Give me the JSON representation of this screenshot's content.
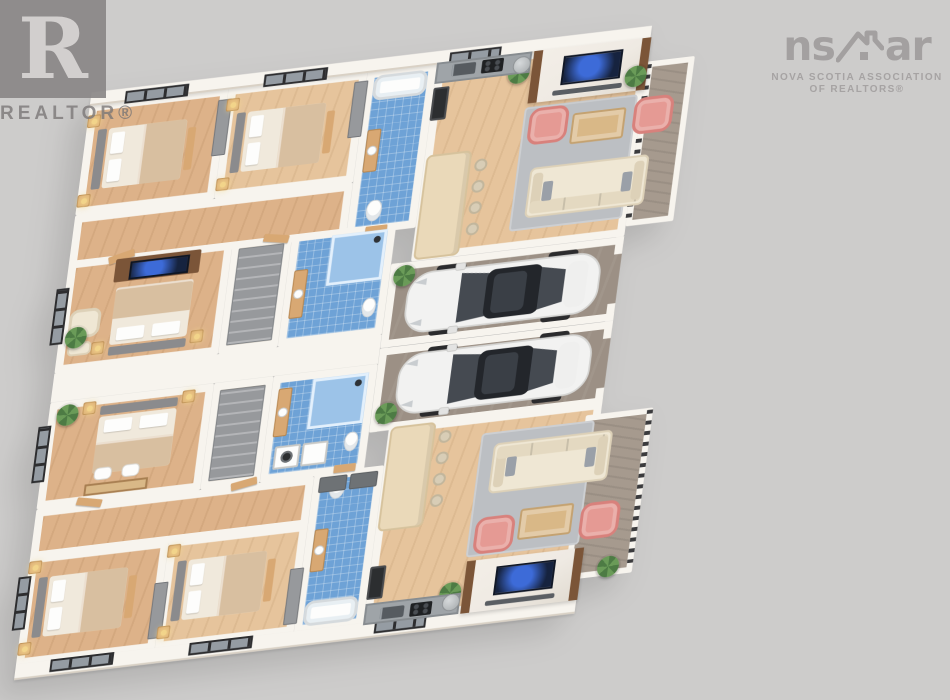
{
  "watermarks": {
    "realtor_glyph": "R",
    "realtor_label": "REALTOR®",
    "nsar_left": "ns",
    "nsar_right": "ar",
    "nsar_sub1": "NOVA SCOTIA ASSOCIATION",
    "nsar_sub2": "OF REALTORS®"
  },
  "palette": {
    "bg": "#cdcccb",
    "wall": "#f7f4ee",
    "wallEdge": "#d9d1c5",
    "wood": "#ddb289",
    "wood2": "#e6c49c",
    "trim": "#d8a873",
    "tile": "#6ea2d6",
    "tileLine": "rgba(255,255,255,0.28)",
    "garage": "#9c9085",
    "deck": "#a69a8e",
    "rug": "#bcbfc3",
    "sofa": "#efe7d4",
    "sofaEdge": "#ddd1b8",
    "pink": "#e59a94",
    "pinkEdge": "#d8817c",
    "linen": "#f0e9dc",
    "blanket": "#d8bfa0",
    "head": "#8b8b8d",
    "cab": "#97999c",
    "counter": "#9fa4a8",
    "counterEdge": "#878c90",
    "island": "#ead9b9",
    "islandEdge": "#d6c29c",
    "steel": "#b4b8ba",
    "car": "#f3f3f2",
    "glass": "#33373d",
    "plant": "#4d7b44",
    "plant2": "#6a9b58",
    "marble": "#efeae3",
    "tvf": "#7b5538",
    "screenc": "#16233f",
    "lamp": "#f2d48a",
    "white": "#fdfdfc",
    "appl": "#2c2e30",
    "rail": "#3b3b3d",
    "winGlass": "#959ca3",
    "winFrame": "#2d2d2f",
    "stoolc": "#d8cdb6",
    "stoolEdge": "#c2b69c",
    "benchg": "#6e7275",
    "deskc": "#d9b887"
  },
  "scene": {
    "units": 2,
    "cars": 2,
    "bedrooms_per_unit": 3,
    "bathrooms_per_unit": 2,
    "items": [
      {
        "t": "room wood",
        "n": "bedroom-1",
        "x": 0,
        "y": 0,
        "w": 140,
        "h": 115
      },
      {
        "t": "room wood2",
        "n": "bedroom-2",
        "x": 140,
        "y": 0,
        "w": 140,
        "h": 115
      },
      {
        "t": "room wood",
        "n": "hallway-top",
        "x": 0,
        "y": 115,
        "w": 280,
        "h": 55
      },
      {
        "t": "room tile",
        "n": "bathroom-1",
        "x": 280,
        "y": 0,
        "w": 70,
        "h": 170
      },
      {
        "t": "room wood2",
        "n": "living-kitchen-1",
        "x": 350,
        "y": 0,
        "w": 215,
        "h": 205
      },
      {
        "t": "room wood",
        "n": "master-bedroom-1",
        "x": 0,
        "y": 162,
        "w": 165,
        "h": 116
      },
      {
        "t": "room wood2",
        "n": "closet-1",
        "x": 165,
        "y": 162,
        "w": 60,
        "h": 116
      },
      {
        "t": "room tile",
        "n": "bathroom-2",
        "x": 225,
        "y": 162,
        "w": 105,
        "h": 116
      },
      {
        "t": "room garage",
        "n": "garage-bay-1",
        "x": 330,
        "y": 205,
        "w": 235,
        "h": 87
      },
      {
        "t": "room garage",
        "n": "garage-bay-2",
        "x": 330,
        "y": 292,
        "w": 235,
        "h": 87
      },
      {
        "t": "room wood",
        "n": "master-bedroom-2",
        "x": 0,
        "y": 308,
        "w": 165,
        "h": 110
      },
      {
        "t": "room wood2",
        "n": "closet-2",
        "x": 165,
        "y": 308,
        "w": 60,
        "h": 110
      },
      {
        "t": "room tile",
        "n": "bathroom-3",
        "x": 225,
        "y": 308,
        "w": 105,
        "h": 110
      },
      {
        "t": "room wood",
        "n": "hallway-bottom",
        "x": 0,
        "y": 418,
        "w": 280,
        "h": 52
      },
      {
        "t": "room tile",
        "n": "bathroom-4",
        "x": 280,
        "y": 415,
        "w": 70,
        "h": 165
      },
      {
        "t": "room wood",
        "n": "bedroom-3",
        "x": 0,
        "y": 466,
        "w": 140,
        "h": 114
      },
      {
        "t": "room wood2",
        "n": "bedroom-4",
        "x": 140,
        "y": 466,
        "w": 140,
        "h": 114
      },
      {
        "t": "room wood2",
        "n": "living-kitchen-2",
        "x": 350,
        "y": 375,
        "w": 215,
        "h": 205
      },
      {
        "t": "room deck",
        "n": "deck-1",
        "x": 565,
        "y": 25,
        "w": 48,
        "h": 170
      },
      {
        "t": "room deck",
        "n": "deck-2",
        "x": 550,
        "y": 388,
        "w": 68,
        "h": 170
      },
      {
        "t": "wallband",
        "n": "party-wall",
        "x": 0,
        "y": 278,
        "w": 330,
        "h": 30
      },
      {
        "t": "facade",
        "n": "north-facade",
        "x": 0,
        "y": -12,
        "w": 565,
        "h": 14
      },
      {
        "t": "facade",
        "n": "south-facade",
        "x": 0,
        "y": 578,
        "w": 565,
        "h": 16
      },
      {
        "t": "stub",
        "n": "garage-door-jamb",
        "x": 557,
        "y": 205,
        "w": 8,
        "h": 18
      },
      {
        "t": "stub",
        "n": "garage-door-jamb",
        "x": 557,
        "y": 274,
        "w": 8,
        "h": 18
      },
      {
        "t": "stub",
        "n": "garage-door-jamb",
        "x": 557,
        "y": 292,
        "w": 8,
        "h": 18
      },
      {
        "t": "stub",
        "n": "garage-door-jamb",
        "x": 557,
        "y": 361,
        "w": 8,
        "h": 18
      },
      {
        "t": "winh",
        "n": "window",
        "x": 35,
        "y": -9,
        "w": 64,
        "h": 13
      },
      {
        "t": "winh",
        "n": "window",
        "x": 175,
        "y": -9,
        "w": 64,
        "h": 13
      },
      {
        "t": "winh",
        "n": "window",
        "x": 362,
        "y": -9,
        "w": 52,
        "h": 13
      },
      {
        "t": "winh",
        "n": "window",
        "x": 35,
        "y": 577,
        "w": 64,
        "h": 13
      },
      {
        "t": "winh",
        "n": "window",
        "x": 175,
        "y": 577,
        "w": 64,
        "h": 13
      },
      {
        "t": "winh",
        "n": "window",
        "x": 362,
        "y": 577,
        "w": 52,
        "h": 13
      },
      {
        "t": "winv",
        "n": "window",
        "x": -9,
        "y": 190,
        "w": 13,
        "h": 58
      },
      {
        "t": "winv",
        "n": "window",
        "x": -9,
        "y": 332,
        "w": 13,
        "h": 58
      },
      {
        "t": "winv",
        "n": "window",
        "x": -9,
        "y": 487,
        "w": 13,
        "h": 55
      },
      {
        "t": "railv",
        "n": "deck-railing",
        "x": 564,
        "y": 28,
        "w": 6,
        "h": 164
      },
      {
        "t": "railv",
        "n": "deck-railing",
        "x": 612,
        "y": 390,
        "w": 6,
        "h": 164
      },
      {
        "t": "door",
        "n": "door",
        "x": 40,
        "y": 160,
        "w": 26,
        "h": 8,
        "r": -14
      },
      {
        "t": "door",
        "n": "door",
        "x": 196,
        "y": 160,
        "w": 26,
        "h": 8,
        "r": 10
      },
      {
        "t": "door",
        "n": "door",
        "x": 299,
        "y": 163,
        "w": 22,
        "h": 8
      },
      {
        "t": "door",
        "n": "door",
        "x": 40,
        "y": 413,
        "w": 26,
        "h": 8,
        "r": 12
      },
      {
        "t": "door",
        "n": "door",
        "x": 196,
        "y": 413,
        "w": 26,
        "h": 8,
        "r": -10
      },
      {
        "t": "door",
        "n": "door",
        "x": 299,
        "y": 409,
        "w": 22,
        "h": 8
      },
      {
        "t": "dresser",
        "n": "dresser",
        "x": 131,
        "y": 12,
        "w": 14,
        "h": 58
      },
      {
        "t": "dresser",
        "n": "dresser",
        "x": 268,
        "y": 10,
        "w": 14,
        "h": 58
      },
      {
        "t": "dresser",
        "n": "dresser",
        "x": 131,
        "y": 510,
        "w": 14,
        "h": 58
      },
      {
        "t": "dresser",
        "n": "dresser",
        "x": 268,
        "y": 512,
        "w": 14,
        "h": 58
      },
      {
        "t": "bed",
        "n": "bed",
        "x": 12,
        "y": 28,
        "w": 100,
        "h": 62
      },
      {
        "t": "bed",
        "n": "bed",
        "x": 152,
        "y": 28,
        "w": 100,
        "h": 62
      },
      {
        "t": "bed",
        "n": "bed",
        "x": 12,
        "y": 490,
        "w": 100,
        "h": 62
      },
      {
        "t": "bed",
        "n": "bed",
        "x": 152,
        "y": 490,
        "w": 100,
        "h": 62
      },
      {
        "t": "bed",
        "v": "v hb-s",
        "n": "bed",
        "x": 52,
        "y": 196,
        "w": 78,
        "h": 70
      },
      {
        "t": "bed",
        "v": "v hb-n",
        "n": "bed",
        "x": 52,
        "y": 318,
        "w": 78,
        "h": 70
      },
      {
        "t": "ns",
        "n": "nightstand-lamp",
        "x": 0,
        "y": 12,
        "w": 13,
        "h": 13
      },
      {
        "t": "ns",
        "n": "nightstand-lamp",
        "x": 0,
        "y": 94,
        "w": 13,
        "h": 13
      },
      {
        "t": "ns",
        "n": "nightstand-lamp",
        "x": 140,
        "y": 12,
        "w": 13,
        "h": 13
      },
      {
        "t": "ns",
        "n": "nightstand-lamp",
        "x": 140,
        "y": 94,
        "w": 13,
        "h": 13
      },
      {
        "t": "ns",
        "n": "nightstand-lamp",
        "x": 0,
        "y": 472,
        "w": 13,
        "h": 13
      },
      {
        "t": "ns",
        "n": "nightstand-lamp",
        "x": 0,
        "y": 556,
        "w": 13,
        "h": 13
      },
      {
        "t": "ns",
        "n": "nightstand-lamp",
        "x": 140,
        "y": 472,
        "w": 13,
        "h": 13
      },
      {
        "t": "ns",
        "n": "nightstand-lamp",
        "x": 140,
        "y": 556,
        "w": 13,
        "h": 13
      },
      {
        "t": "ns",
        "n": "nightstand-lamp",
        "x": 34,
        "y": 250,
        "w": 13,
        "h": 13
      },
      {
        "t": "ns",
        "n": "nightstand-lamp",
        "x": 134,
        "y": 250,
        "w": 13,
        "h": 13
      },
      {
        "t": "ns",
        "n": "nightstand-lamp",
        "x": 34,
        "y": 312,
        "w": 13,
        "h": 13
      },
      {
        "t": "ns",
        "n": "nightstand-lamp",
        "x": 134,
        "y": 312,
        "w": 13,
        "h": 13
      },
      {
        "t": "tvc",
        "n": "tv-console",
        "x": 48,
        "y": 166,
        "w": 86,
        "h": 24
      },
      {
        "t": "armch",
        "n": "armchair",
        "x": 8,
        "y": 214,
        "w": 32,
        "h": 30
      },
      {
        "t": "otto",
        "n": "ottoman",
        "x": 10,
        "y": 248,
        "w": 24,
        "h": 14
      },
      {
        "t": "desk",
        "n": "desk",
        "x": 46,
        "y": 398,
        "w": 64,
        "h": 12
      },
      {
        "t": "chairw",
        "n": "chair",
        "x": 54,
        "y": 382,
        "w": 18,
        "h": 13
      },
      {
        "t": "chairw",
        "n": "chair",
        "x": 82,
        "y": 382,
        "w": 18,
        "h": 13
      },
      {
        "t": "shelf",
        "n": "closet-shelving",
        "x": 172,
        "y": 170,
        "w": 46,
        "h": 100
      },
      {
        "t": "shelf",
        "n": "closet-shelving",
        "x": 172,
        "y": 316,
        "w": 46,
        "h": 94
      },
      {
        "t": "tub",
        "n": "bathtub",
        "x": 288,
        "y": 6,
        "w": 54,
        "h": 26
      },
      {
        "t": "wc",
        "n": "toilet",
        "x": 297,
        "y": 136,
        "w": 16,
        "h": 22
      },
      {
        "t": "vanity",
        "n": "vanity",
        "x": 288,
        "y": 62,
        "w": 14,
        "h": 44
      },
      {
        "t": "tub",
        "n": "bathtub",
        "x": 288,
        "y": 548,
        "w": 54,
        "h": 26
      },
      {
        "t": "wc",
        "n": "toilet",
        "x": 297,
        "y": 422,
        "w": 16,
        "h": 22
      },
      {
        "t": "vanity",
        "n": "vanity",
        "x": 288,
        "y": 474,
        "w": 14,
        "h": 44
      },
      {
        "t": "shower",
        "n": "shower",
        "x": 266,
        "y": 168,
        "w": 56,
        "h": 52
      },
      {
        "t": "vanity",
        "n": "vanity",
        "x": 232,
        "y": 200,
        "w": 14,
        "h": 50
      },
      {
        "t": "wc",
        "n": "toilet",
        "x": 306,
        "y": 238,
        "w": 14,
        "h": 20
      },
      {
        "t": "shower",
        "n": "shower",
        "x": 266,
        "y": 316,
        "w": 56,
        "h": 52
      },
      {
        "t": "vanity",
        "n": "vanity",
        "x": 232,
        "y": 322,
        "w": 14,
        "h": 50
      },
      {
        "t": "wc",
        "n": "toilet",
        "x": 306,
        "y": 376,
        "w": 14,
        "h": 20
      },
      {
        "t": "washer",
        "n": "washing-machine",
        "x": 236,
        "y": 382,
        "w": 26,
        "h": 24
      },
      {
        "t": "dryer",
        "n": "dryer",
        "x": 264,
        "y": 382,
        "w": 26,
        "h": 24
      },
      {
        "t": "benchg",
        "n": "bench",
        "x": 286,
        "y": 420,
        "w": 28,
        "h": 16
      },
      {
        "t": "benchg",
        "n": "bench",
        "x": 317,
        "y": 420,
        "w": 28,
        "h": 16
      },
      {
        "t": "rug",
        "n": "area-rug",
        "x": 446,
        "y": 58,
        "w": 114,
        "h": 128
      },
      {
        "t": "tvwall",
        "n": "tv-feature-wall",
        "x": 448,
        "y": 0,
        "w": 118,
        "h": 54
      },
      {
        "t": "plant",
        "n": "plant",
        "x": 424,
        "y": 10,
        "w": 22,
        "h": 22
      },
      {
        "t": "plant",
        "n": "plant",
        "x": 544,
        "y": 28,
        "w": 22,
        "h": 22
      },
      {
        "t": "pchair",
        "n": "pink-armchair",
        "x": 452,
        "y": 60,
        "w": 40,
        "h": 38
      },
      {
        "t": "pchair",
        "n": "pink-armchair",
        "x": 558,
        "y": 62,
        "w": 40,
        "h": 38
      },
      {
        "t": "coffee",
        "n": "coffee-table",
        "x": 496,
        "y": 70,
        "w": 54,
        "h": 32
      },
      {
        "t": "sofa",
        "v": "back-s",
        "n": "sofa",
        "x": 460,
        "y": 122,
        "w": 120,
        "h": 52
      },
      {
        "t": "island",
        "n": "kitchen-island",
        "x": 352,
        "y": 96,
        "w": 46,
        "h": 108
      },
      {
        "t": "stool",
        "n": "bar-stool",
        "x": 402,
        "y": 106,
        "w": 13,
        "h": 13
      },
      {
        "t": "stool",
        "n": "bar-stool",
        "x": 402,
        "y": 128,
        "w": 13,
        "h": 13
      },
      {
        "t": "stool",
        "n": "bar-stool",
        "x": 402,
        "y": 150,
        "w": 13,
        "h": 13
      },
      {
        "t": "stool",
        "n": "bar-stool",
        "x": 402,
        "y": 172,
        "w": 13,
        "h": 13
      },
      {
        "t": "counter",
        "n": "kitchen-counter",
        "x": 350,
        "y": 0,
        "w": 96,
        "h": 22
      },
      {
        "t": "sinkD",
        "n": "kitchen-sink",
        "x": 366,
        "y": 4,
        "w": 24,
        "h": 12
      },
      {
        "t": "cooktop",
        "n": "cooktop",
        "x": 396,
        "y": 3,
        "w": 22,
        "h": 14
      },
      {
        "t": "steel",
        "n": "appliance",
        "x": 428,
        "y": 4,
        "w": 18,
        "h": 18
      },
      {
        "t": "appl",
        "n": "oven-tower",
        "x": 350,
        "y": 26,
        "w": 16,
        "h": 34
      },
      {
        "t": "plant",
        "n": "plant",
        "x": 334,
        "y": 208,
        "w": 22,
        "h": 22
      },
      {
        "t": "plant",
        "n": "plant",
        "x": 334,
        "y": 350,
        "w": 22,
        "h": 22
      },
      {
        "t": "car",
        "n": "white-sedan",
        "x": 342,
        "y": 212,
        "w": 212,
        "h": 74
      },
      {
        "t": "car",
        "n": "white-sedan",
        "x": 344,
        "y": 296,
        "w": 212,
        "h": 74
      },
      {
        "t": "rug",
        "n": "area-rug",
        "x": 446,
        "y": 394,
        "w": 114,
        "h": 128
      },
      {
        "t": "tvwall",
        "n": "tv-feature-wall",
        "x": 448,
        "y": 526,
        "w": 118,
        "h": 54
      },
      {
        "t": "plant",
        "n": "plant",
        "x": 424,
        "y": 546,
        "w": 22,
        "h": 22
      },
      {
        "t": "plant",
        "n": "plant",
        "x": 582,
        "y": 538,
        "w": 22,
        "h": 22
      },
      {
        "t": "pchair",
        "n": "pink-armchair",
        "x": 452,
        "y": 482,
        "w": 40,
        "h": 38
      },
      {
        "t": "pchair",
        "n": "pink-armchair",
        "x": 558,
        "y": 480,
        "w": 40,
        "h": 38
      },
      {
        "t": "coffee",
        "n": "coffee-table",
        "x": 496,
        "y": 478,
        "w": 54,
        "h": 32
      },
      {
        "t": "sofa",
        "v": "back-n",
        "n": "sofa",
        "x": 460,
        "y": 406,
        "w": 120,
        "h": 52
      },
      {
        "t": "island",
        "n": "kitchen-island",
        "x": 352,
        "y": 376,
        "w": 46,
        "h": 108
      },
      {
        "t": "stool",
        "n": "bar-stool",
        "x": 402,
        "y": 386,
        "w": 13,
        "h": 13
      },
      {
        "t": "stool",
        "n": "bar-stool",
        "x": 402,
        "y": 408,
        "w": 13,
        "h": 13
      },
      {
        "t": "stool",
        "n": "bar-stool",
        "x": 402,
        "y": 430,
        "w": 13,
        "h": 13
      },
      {
        "t": "stool",
        "n": "bar-stool",
        "x": 402,
        "y": 452,
        "w": 13,
        "h": 13
      },
      {
        "t": "counter",
        "n": "kitchen-counter",
        "x": 350,
        "y": 558,
        "w": 96,
        "h": 22
      },
      {
        "t": "sinkD",
        "n": "kitchen-sink",
        "x": 366,
        "y": 564,
        "w": 24,
        "h": 12
      },
      {
        "t": "cooktop",
        "n": "cooktop",
        "x": 396,
        "y": 563,
        "w": 22,
        "h": 14
      },
      {
        "t": "steel",
        "n": "appliance",
        "x": 428,
        "y": 558,
        "w": 18,
        "h": 18
      },
      {
        "t": "appl",
        "n": "oven-tower",
        "x": 350,
        "y": 520,
        "w": 16,
        "h": 34
      },
      {
        "t": "plant",
        "n": "plant",
        "x": 6,
        "y": 232,
        "w": 22,
        "h": 22
      },
      {
        "t": "plant",
        "n": "plant",
        "x": 8,
        "y": 312,
        "w": 22,
        "h": 22
      }
    ]
  }
}
